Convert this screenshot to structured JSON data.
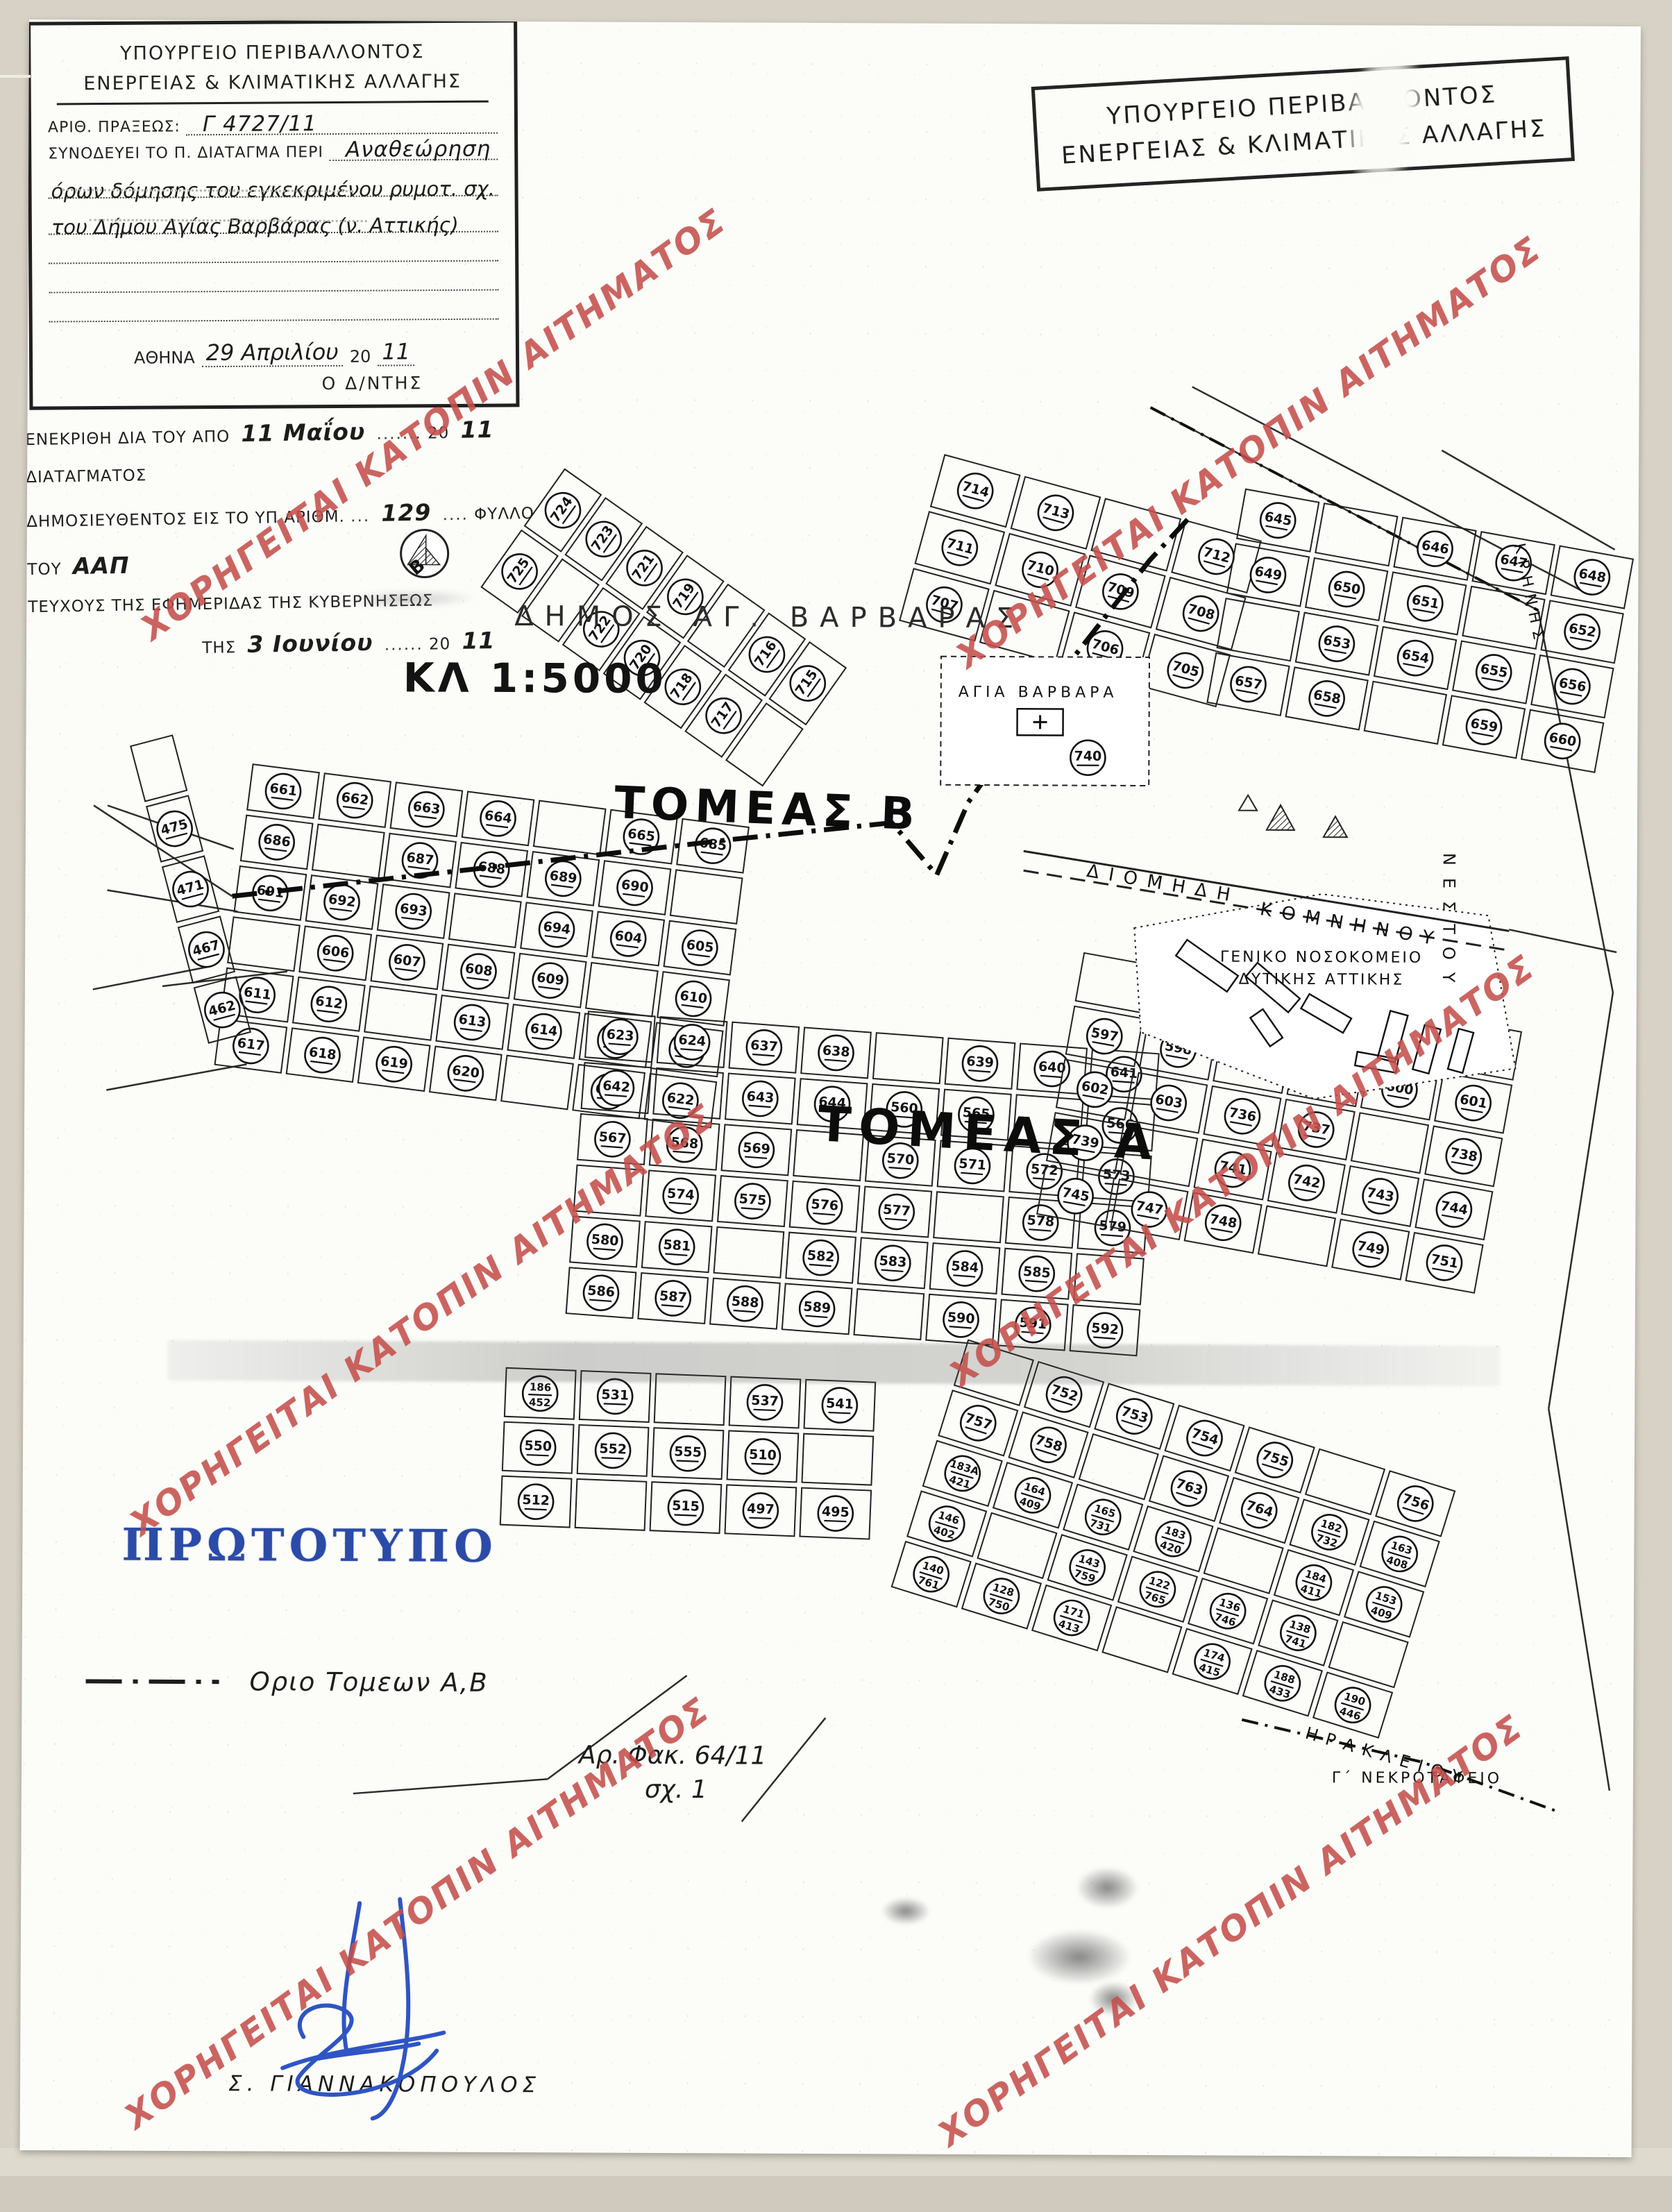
{
  "watermark": {
    "text": "ΧΟΡΗΓΕΙΤΑΙ ΚΑΤΟΠΙΝ ΑΙΤΗΜΑΤΟΣ",
    "color": "#c5504c"
  },
  "ministry_stamp": {
    "line1": "ΥΠΟΥΡΓΕΙΟ ΠΕΡΙΒΑΛΛΟΝΤΟΣ",
    "line2": "ΕΝΕΡΓΕΙΑΣ & ΚΛΙΜΑΤΙΚΗΣ ΑΛΛΑΓΗΣ"
  },
  "map": {
    "title": "ΔΗΜΟΣ ΑΓ. ΒΑΡΒΑΡΑΣ",
    "scale": "ΚΛ 1:5000",
    "sector_a": "ΤΟΜΕΑΣ Α",
    "sector_b": "ΤΟΜΕΑΣ Β",
    "labels": {
      "church": "ΑΓΙΑ ΒΑΡΒΑΡΑ",
      "church_block": "740",
      "hospital_line1": "ΓΕΝΙΚΟ ΝΟΣΟΚΟΜΕΙΟ",
      "hospital_line2": "ΔΥΤΙΚΗΣ ΑΤΤΙΚΗΣ",
      "cemetery": "Γ΄ ΝΕΚΡΟΤΑΦΕΙΟ"
    },
    "streets": [
      "ΔΙΟΜΗΔΗ",
      "ΚΟΜΝΗΝΟΥ",
      "ΗΡΑΚΛΕΙΟΥ",
      "ΝΕΣΤΟΥ",
      "ΚΡΗΝΗΣ"
    ],
    "block_numbers": [
      "725",
      "724",
      "723",
      "722",
      "721",
      "720",
      "719",
      "718",
      "717",
      "716",
      "715",
      "714",
      "713",
      "712",
      "711",
      "710",
      "709",
      "708",
      "707",
      "706",
      "705",
      "645",
      "646",
      "647",
      "648",
      "649",
      "650",
      "651",
      "652",
      "653",
      "654",
      "655",
      "656",
      "657",
      "658",
      "659",
      "660",
      "661",
      "662",
      "663",
      "664",
      "665",
      "685",
      "686",
      "687",
      "688",
      "689",
      "690",
      "691",
      "692",
      "693",
      "694",
      "604",
      "605",
      "606",
      "607",
      "608",
      "609",
      "610",
      "611",
      "612",
      "613",
      "614",
      "615",
      "616",
      "617",
      "618",
      "619",
      "620",
      "621",
      "622",
      "623",
      "624",
      "637",
      "638",
      "639",
      "640",
      "641",
      "642",
      "643",
      "644",
      "560",
      "565",
      "566",
      "567",
      "568",
      "569",
      "570",
      "571",
      "572",
      "573",
      "574",
      "575",
      "576",
      "577",
      "578",
      "579",
      "580",
      "581",
      "582",
      "583",
      "584",
      "585",
      "586",
      "587",
      "588",
      "589",
      "590",
      "591",
      "592",
      "593",
      "594",
      "595",
      "596",
      "597",
      "598",
      "599",
      "600",
      "601",
      "602",
      "603",
      "736",
      "737",
      "738",
      "739",
      "741",
      "742",
      "743",
      "744",
      "745",
      "747",
      "748",
      "749",
      "751",
      "752",
      "753",
      "754",
      "755",
      "756",
      "757",
      "758",
      "763",
      "764",
      "182/732",
      "163/408",
      "183Α/421",
      "164/409",
      "165/731",
      "183/420",
      "184/411",
      "153/409",
      "146/402",
      "143/759",
      "122/765",
      "136/746",
      "138/741",
      "140/761",
      "128/750",
      "171/413",
      "174/415",
      "188/433",
      "190/446",
      "186/452",
      "531",
      "537",
      "541",
      "550",
      "552",
      "555",
      "510",
      "512",
      "515",
      "497",
      "495",
      "475",
      "471",
      "467",
      "462",
      "452",
      "621α",
      "621δ"
    ],
    "legend_label": "Οριο Τομεων Α,Β"
  },
  "original_stamp": {
    "text": "ΠΡΩΤΟΤΥΠΟ",
    "color": "#2b4ba8"
  },
  "approval_box": {
    "title1": "ΥΠΟΥΡΓΕΙΟ ΠΕΡΙΒΑΛΛΟΝΤΟΣ",
    "title2": "ΕΝΕΡΓΕΙΑΣ & ΚΛΙΜΑΤΙΚΗΣ ΑΛΛΑΓΗΣ",
    "act_label": "ΑΡΙΘ. ΠΡΑΞΕΩΣ:",
    "act_value": "Γ 4727/11",
    "accompanies_label": "ΣΥΝΟΔΕΥΕΙ ΤΟ Π. ΔΙΑΤΑΓΜΑ ΠΕΡΙ",
    "subject_line1": "Αναθεώρηση",
    "subject_line2": "όρων δόμησης του εγκεκριμένου ρυμοτ. σχ.",
    "subject_line3": "του Δήμου Αγίας Βαρβάρας (ν. Αττικής)",
    "city_label": "ΑΘΗΝΑ",
    "date_hand": "29 Απριλίου",
    "year_print": "20",
    "year_hand": "11",
    "director_label": "Ο Δ/ΝΤΗΣ",
    "signer": "Σ. ΓΙΑΝΝΑΚΟΠΟΥΛΟΣ"
  },
  "file_note": {
    "line1": "Αρ. Φακ. 64/11",
    "line2": "σχ. 1"
  },
  "gazette_stamp": {
    "line1_pre": "ΕΝΕΚΡΙΘΗ ΔΙΑ ΤΟΥ ΑΠΟ",
    "line1_hand": "11 Μαΐου",
    "year_print": "20",
    "line1_year_hand": "11",
    "line1_post": "ΔΙΑΤΑΓΜΑΤΟΣ",
    "line2_pre": "ΔΗΜΟΣΙΕΥΘΕΝΤΟΣ ΕΙΣ ΤΟ ΥΠ ΑΡΙΘΜ.",
    "line2_hand": "129",
    "line2_mid": "ΦΥΛΛΟ ΤΟΥ",
    "line2_hand2": "ΑΑΠ",
    "line3": "ΤΕΥΧΟΥΣ ΤΗΣ ΕΦΗΜΕΡΙΔΑΣ ΤΗΣ ΚΥΒΕΡΝΗΣΕΩΣ",
    "line4_pre": "ΤΗΣ",
    "line4_hand": "3 Ιουνίου",
    "line4_year_hand": "11"
  }
}
